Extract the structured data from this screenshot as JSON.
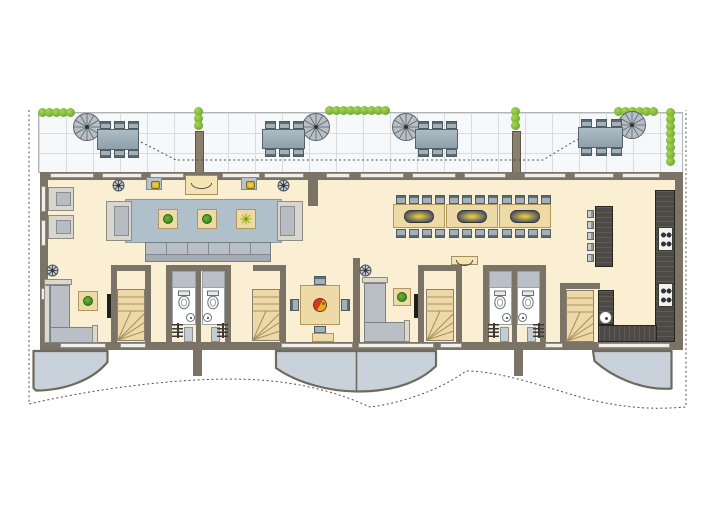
{
  "title": "Apartment storey floor plan with roof terrace",
  "palette": {
    "wall": "#7b7365",
    "floor": "#fbefd3",
    "terrace": "#f6f8f9",
    "terraceLine": "#d7dce0",
    "rug": "#b0c0cb",
    "wood": "#eedaa6",
    "woodEdge": "#b1965e",
    "darkWood": "#4d4a45",
    "balcony": "#c9d2da",
    "dash": "#55504a",
    "shower": "#b9c0c7",
    "hedgeGreen": "#78b236",
    "lampYellow": "#f2d04e",
    "fruitRed": "#d23a26",
    "fruitYellow": "#f0a81f"
  },
  "inventory": {
    "terrace": {
      "label": "roof terrace",
      "spiral_staircases": 4,
      "dining_sets": 4,
      "planters": 2,
      "hedge_rows": 5
    },
    "living_area": {
      "armchairs": 4,
      "side_tables_with_plants": 3,
      "long_sofa_sections": 6,
      "wall_lamps": 2,
      "sideboards": 2,
      "ceiling_spots": 4
    },
    "dining_area": {
      "tables": 3,
      "chairs": 24,
      "pendant_lamps": 3
    },
    "kitchen": {
      "bar_stools": 5,
      "cooktops": 2,
      "burners_per_cooktop": 4,
      "sinks": 1,
      "counters": 4
    },
    "lower_rooms": {
      "wc_rooms": 4,
      "toilets": 4,
      "hand_basins": 4,
      "showers": 4,
      "winder_staircases": 4,
      "radiators": 4,
      "door_leaves": 4,
      "corner_sofas": 2,
      "square_dining_table_chairs": 4,
      "benches": 1,
      "tv_sets": 2,
      "plant_tables": 2,
      "fruit_bowls": 1
    },
    "balconies": 3
  }
}
